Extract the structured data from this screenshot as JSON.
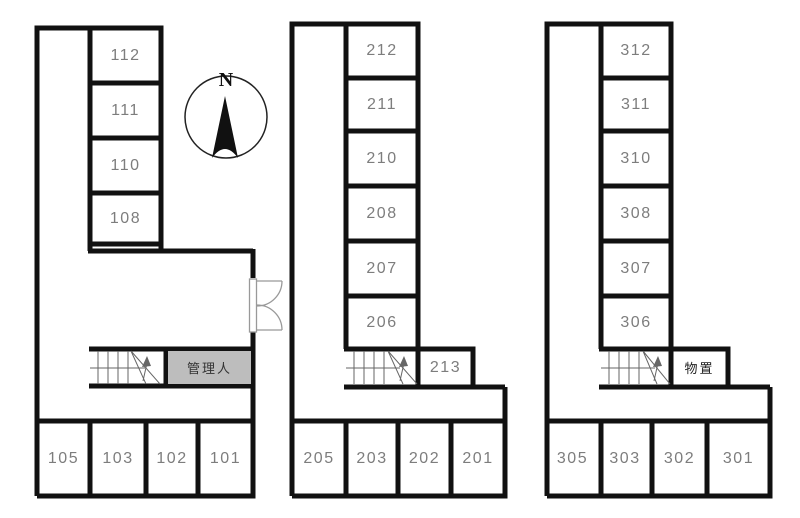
{
  "colors": {
    "wall": "#111111",
    "room_number_text": "#7d7d7d",
    "manager_room_bg": "#bdbdbd",
    "special_label_text": "#333333"
  },
  "compass": {
    "label": "N"
  },
  "floors": [
    {
      "stack_rooms": [
        "112",
        "111",
        "110",
        "108"
      ],
      "annex_room": "管理人",
      "bottom_rooms": [
        "105",
        "103",
        "102",
        "101"
      ]
    },
    {
      "stack_rooms": [
        "212",
        "211",
        "210",
        "208",
        "207",
        "206"
      ],
      "annex_room": "213",
      "bottom_rooms": [
        "205",
        "203",
        "202",
        "201"
      ]
    },
    {
      "stack_rooms": [
        "312",
        "311",
        "310",
        "308",
        "307",
        "306"
      ],
      "annex_room": "物置",
      "bottom_rooms": [
        "305",
        "303",
        "302",
        "301"
      ]
    }
  ]
}
